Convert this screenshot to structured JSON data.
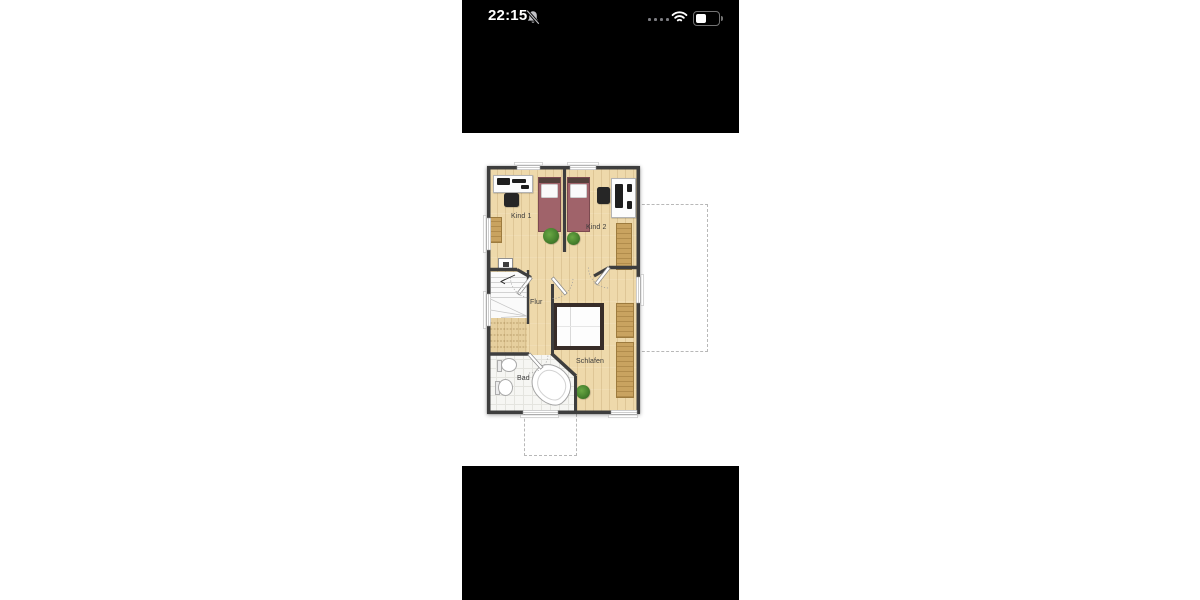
{
  "status_bar": {
    "time": "22:15",
    "notifications_muted": true,
    "signal_dots": 4,
    "battery_percent": 40
  },
  "floorplan": {
    "rooms": {
      "kind1": "Kind 1",
      "kind2": "Kind 2",
      "flur": "Flur",
      "schlafen": "Schlafen",
      "bad": "Bad"
    },
    "colors": {
      "wood_floor": "#eed9ab",
      "furniture_wood": "#c9a360",
      "bed_red": "#a0636a",
      "bed_frame_dark": "#382d28",
      "wall": "#3e3e3e",
      "bath_tile": "#f6f6f3",
      "plant": "#3f7d27",
      "dashed_outline": "#b8b8b8"
    }
  }
}
